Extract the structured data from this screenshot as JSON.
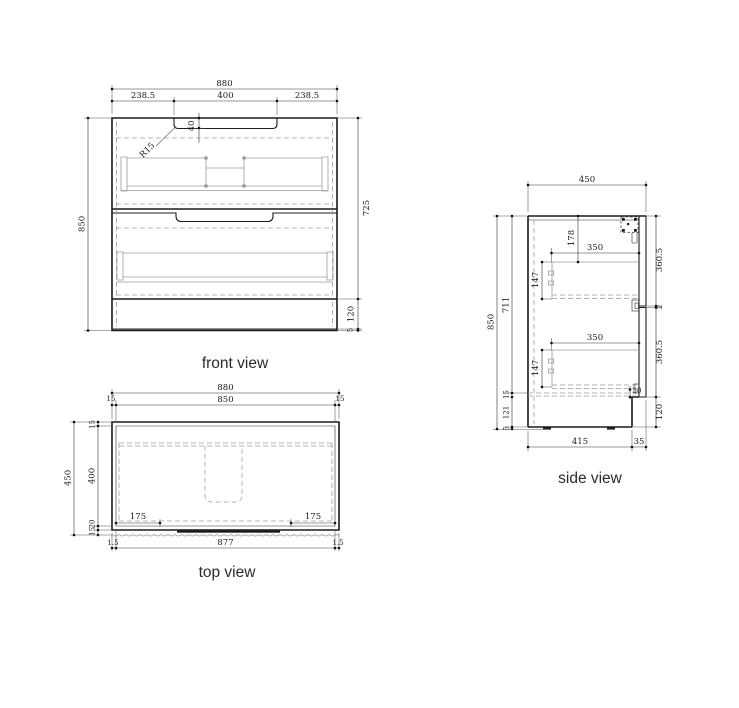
{
  "front": {
    "label": "front view",
    "w_total": "880",
    "w_left": "238.5",
    "w_handle": "400",
    "w_right": "238.5",
    "handle_depth": "40",
    "handle_radius": "R15",
    "h_total": "850",
    "h_body": "725",
    "h_base": "120",
    "h_foot": "5"
  },
  "top": {
    "label": "top view",
    "w_total": "880",
    "w_inner": "850",
    "edge_l": "15",
    "edge_r": "15",
    "d_total": "450",
    "d_back": "15",
    "d_inner": "400",
    "d_lip": "20",
    "d_front": "15",
    "hinge_l": "175",
    "hinge_r": "175",
    "b_edge_l": "1.5",
    "b_width": "877",
    "b_edge_r": "1.5"
  },
  "side": {
    "label": "side view",
    "d_total": "450",
    "h_total": "850",
    "h_inner": "711",
    "drawer1_top": "178",
    "drawer1_depth": "350",
    "drawer1_h": "147",
    "drawer2_depth": "350",
    "drawer2_h": "147",
    "panel1": "360.5",
    "gap": "2",
    "panel2": "360.5",
    "h_base": "120",
    "clearance": "30",
    "base_gap": "15",
    "h_kick": "121",
    "h_foot": "5",
    "b_depth": "415",
    "b_offset": "35"
  }
}
